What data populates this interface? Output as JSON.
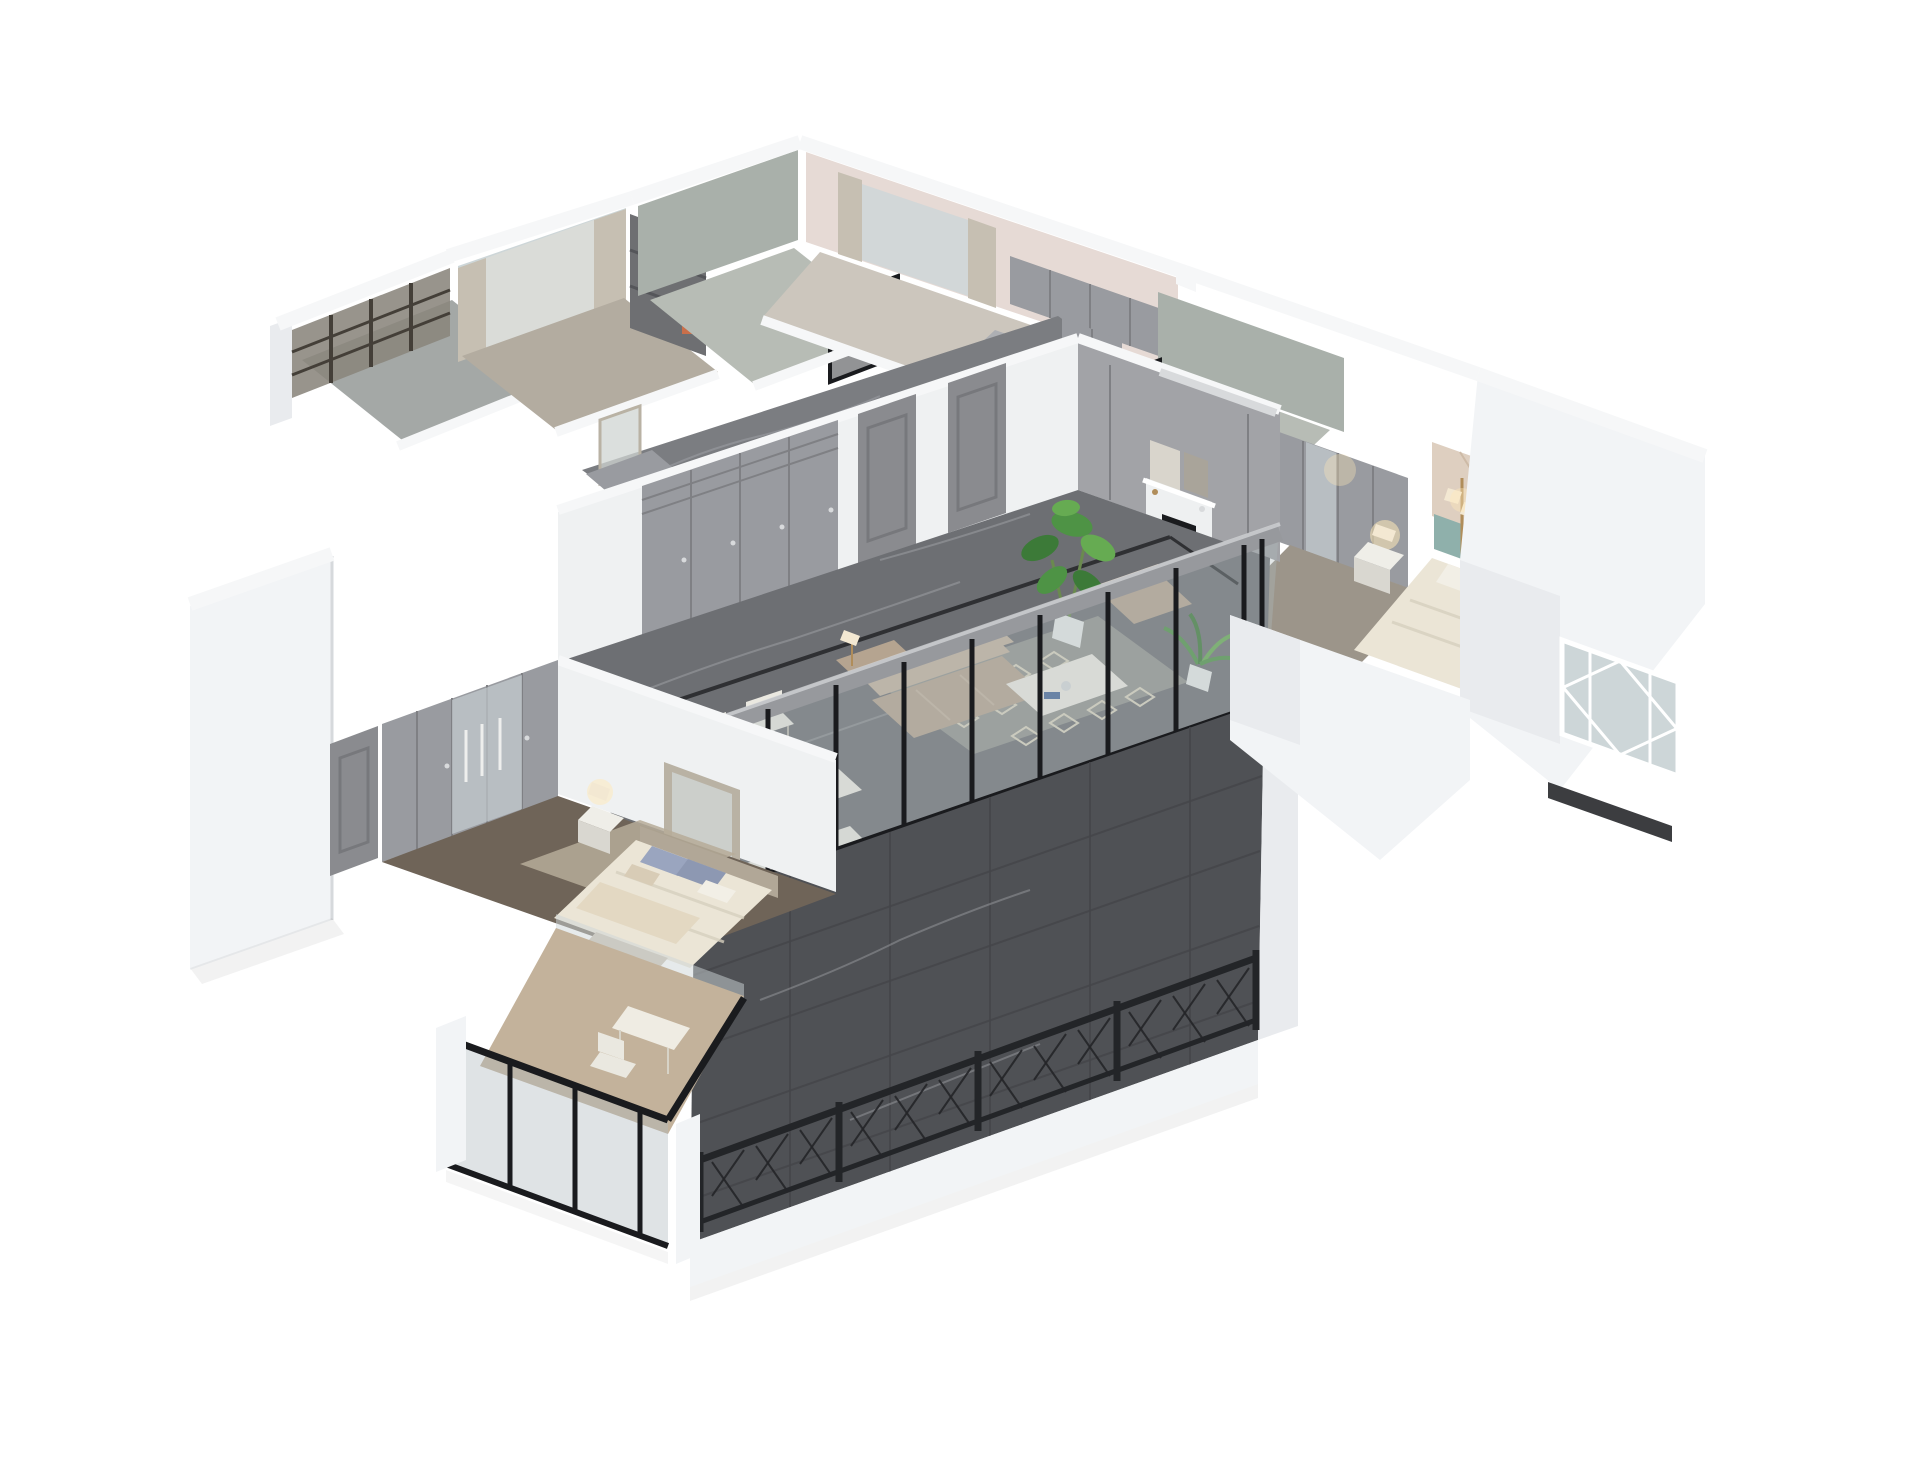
{
  "meta": {
    "type": "3d-render",
    "subject": "isometric dollhouse cutaway render of an apartment interior",
    "style": "photorealistic architectural visualization, light gray / greige palette",
    "background": "#ffffff",
    "image_size": "1920x1468",
    "visible_text": "none"
  },
  "palette": {
    "bg": "#ffffff",
    "wallTop": "#f6f7f8",
    "wallBright": "#f2f4f6",
    "wallLight": "#e9ebee",
    "wallFace": "#eff1f2",
    "wallShade": "#d6d9dc",
    "balconyFloor": "#a4a8a6",
    "bronzeGlass": "#8a857c",
    "latticeDark": "#443f38",
    "glassCool": "#cdd6d8",
    "curtain": "#c6bfb2",
    "sheer": "#e5e2d9",
    "studyFloor": "#b3aca0",
    "shelfDark": "#6e6f72",
    "bookRed": "#b0493f",
    "bookBlue": "#46689a",
    "bookTan": "#cbb87e",
    "greenWall": "#a9b0aa",
    "bathFloor": "#b7bcb5",
    "darkGlass": "#26282b",
    "pinkWall": "#e6dad5",
    "cabGray": "#999ba0",
    "cabGrayLight": "#adafb3",
    "cabGrayDark": "#7d7e82",
    "kitchenFloor": "#ccc6bd",
    "tileWall": "#decfc0",
    "tileLine": "#cdbaa6",
    "teal": "#8fb0ab",
    "bedding": "#ebe5d6",
    "beddingShade": "#d6cfbe",
    "pillowWhite": "#f2efe6",
    "pillowTan": "#d8ccb6",
    "pillowBlue": "#9aa5bf",
    "pillowBlueDark": "#8d98b2",
    "nightstand": "#efeee8",
    "nightstandShade": "#d9d7d0",
    "glow": "#ffe9b8",
    "lampShade": "#f3e8d2",
    "brass": "#b08d5a",
    "masterFloor": "#9c958a",
    "marbleMid": "#6d6f73",
    "marbleMid2": "#7b7d81",
    "marbleVein": "#a6a8ac",
    "inlay": "#2f3033",
    "marbleDark": "#4f5155",
    "tableWhite": "#efece3",
    "tableShade": "#d7d3c7",
    "plate": "#c9cdd1",
    "chairWhite": "#eae8e0",
    "chairLeg": "#b9b6ac",
    "rug": "#92948f",
    "rugPattern": "#d9d3bf",
    "sofa": "#b5a490",
    "sofaLight": "#c3b29e",
    "panelWall": "#a2a3a7",
    "doorGray": "#8a8b8f",
    "fireplaceWhite": "#eef0f1",
    "frameBlack": "#1a1b1e",
    "fire": "#f59b2d",
    "fireBright": "#ffd27a",
    "artMat": "#d9d5cc",
    "artDark": "#a9a49a",
    "silver": "#d8dadc",
    "beamGray": "#97999d",
    "glassBlue": "#aeb9bd",
    "railDark": "#232528",
    "carpetBrown": "#6f6458",
    "rugTan": "#b6ab99",
    "headboard2": "#b1a797",
    "blanket": "#e3d8c2",
    "benchTan": "#c9beae",
    "mirrorFrame": "#b9b2a4",
    "mirrorGlass": "#cfd4d2",
    "woodLight": "#c3b29b",
    "potWhite": "#e9ebea",
    "plant": "#4e9345",
    "plantDark": "#3c7a38",
    "plantLight": "#66ab52",
    "plantStem": "#6a8a4f"
  },
  "scene": {
    "view": "high-angle axonometric, walls cut at uniform height, pure white backdrop",
    "rooms": [
      {
        "name": "service-balcony",
        "position": "top-left",
        "finishes": "bronze lattice glazing, gray concrete floor",
        "furniture": []
      },
      {
        "name": "study",
        "position": "upper-left",
        "finishes": "curtained window, light wood floor",
        "furniture": [
          "bookshelf with books",
          "art print"
        ]
      },
      {
        "name": "bathroom",
        "position": "top-center",
        "finishes": "sage-green plaster walls, smoked glass shower screen",
        "furniture": []
      },
      {
        "name": "kitchen",
        "position": "top",
        "finishes": "blush-pink walls, curtained window",
        "furniture": [
          "gray upper cabinets",
          "gray base cabinets"
        ]
      },
      {
        "name": "second-bathroom",
        "position": "upper-right",
        "finishes": "sage-green walls, black framed glass door",
        "furniture": []
      },
      {
        "name": "master-bedroom",
        "position": "right",
        "finishes": "beige geometric tile accent wall",
        "furniture": [
          "gray wardrobe with glass doors",
          "teal upholstered headboard bed",
          "nightstand with lamp",
          "floor lamp"
        ]
      },
      {
        "name": "bay-window-wing",
        "position": "far-right",
        "finishes": "thick white walls, white diamond-lattice window",
        "furniture": []
      },
      {
        "name": "entry-corridor",
        "position": "center-upper",
        "finishes": "gray marble floor",
        "furniture": [
          "gray console with mirror",
          "entry cabinet"
        ]
      },
      {
        "name": "living-dining-hall",
        "position": "center",
        "finishes": "gray marble floor with dark inlay border, white wall with built-in gray wardrobe and two paneled doors, gray paneled fireplace wall, black framed glass sliding wall",
        "furniture": [
          "taupe leather sofa",
          "chaise",
          "white coffee table",
          "armchair",
          "trellis-pattern rug",
          "white fireplace with burning fire",
          "two art frames",
          "monstera plant",
          "palm plant",
          "cream dining table with place settings",
          "five white cross-back chairs",
          "linear AC diffuser"
        ]
      },
      {
        "name": "terrace",
        "position": "bottom-center",
        "finishes": "dark gray marble tile floor, black metal lattice railing, white slab edge",
        "furniture": []
      },
      {
        "name": "second-bedroom",
        "position": "lower-left",
        "finishes": "dark brown carpet, tan rug",
        "furniture": [
          "gray five-door wardrobe with mirrored middle doors",
          "paneled door",
          "bed with blue and tan pillows",
          "cream blanket",
          "tall leaning mirror",
          "nightstand with lamp",
          "foot bench"
        ]
      },
      {
        "name": "bedroom-balcony",
        "position": "bottom-left",
        "finishes": "light wood floor, black framed full-height glazing",
        "furniture": [
          "white desk",
          "white chair"
        ]
      }
    ]
  }
}
